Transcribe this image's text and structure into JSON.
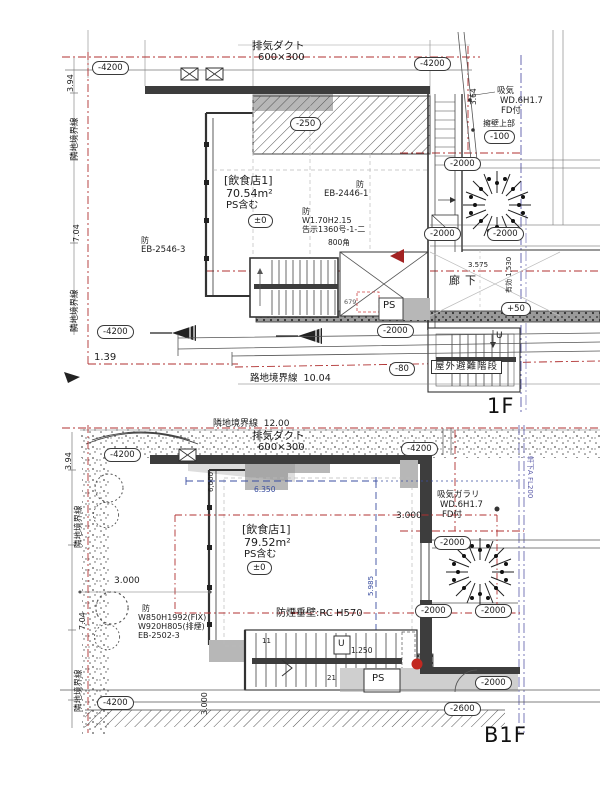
{
  "f1": {
    "floor_label": "1F",
    "duct": [
      "排気ダクト",
      "600×300"
    ],
    "unit": [
      "[飲食店1]",
      "70.54m²",
      "PS含む"
    ],
    "level_pm0": "±0",
    "fire_eb2446": [
      "防",
      "EB-2446-1"
    ],
    "fire_w170": [
      "防",
      "W1.70H2.15",
      "告示1360号-1-二"
    ],
    "fire_eb2546": [
      "防",
      "EB-2546-3"
    ],
    "sq800": "800角",
    "corridor": "廊下",
    "dim_3575": "3.575",
    "eff_width": "有効 1,530",
    "dim_679": "679",
    "ps": "PS",
    "evac_stair": "屋外避難階段",
    "up": "U",
    "dim_139": "1.39",
    "road_boundary": "路地境界線  10.04",
    "site_boundary": "隣地境界線",
    "dim_704": "7.04",
    "dim_394": "3.94",
    "dim_364": "3.64",
    "intake": [
      "吸気",
      "WD.6H1.7",
      "FD付"
    ],
    "retaining_wall": "擁壁上部",
    "levels": {
      "m4200": "-4200",
      "m2000": "-2000",
      "m250": "-250",
      "m100": "-100",
      "m80": "-80",
      "p50": "+50"
    }
  },
  "b1": {
    "floor_label": "B1F",
    "boundary_top": "隣地境界線  12.00",
    "duct": [
      "排気ダクト",
      "600×300"
    ],
    "unit": [
      "[飲食店1]",
      "79.52m²",
      "PS含む"
    ],
    "level_pm0": "±0",
    "smoke_wall": "防煙垂壁:RC H570",
    "fire_window": [
      "防",
      "W850H1992(FIX)",
      "W920H805(排煙)",
      "EB-2502-3"
    ],
    "intake_louver": [
      "吸気ガラリ",
      "WD.6H1.7",
      "FD付"
    ],
    "site_boundary": "隣地境界線",
    "dim_704": "7.04",
    "dim_394": "3.94",
    "dim_6000": "6,000",
    "dim_6350": "6.350",
    "dim_5985": "5.985",
    "dim_3000": "3.000",
    "dim_1250": "1.250",
    "tread_11": "11",
    "tread_21": "21",
    "up": "U",
    "ps": "PS",
    "eave_note": "軒下A FL200",
    "levels": {
      "m4200": "-4200",
      "m2000": "-2000",
      "m2600": "-2600"
    }
  }
}
